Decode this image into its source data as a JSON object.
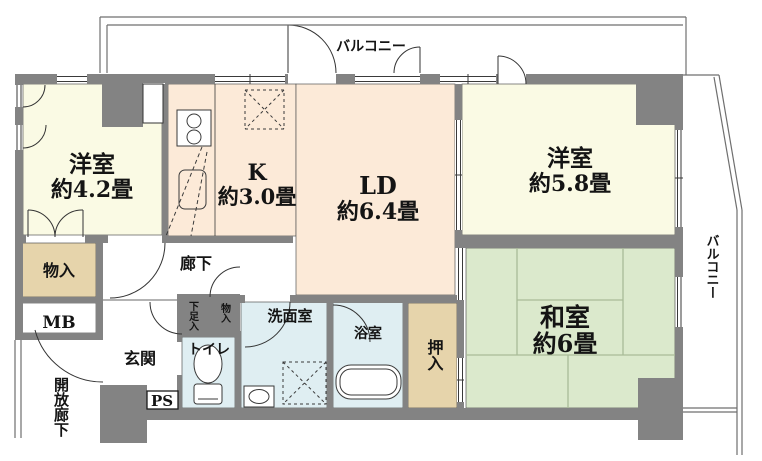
{
  "title": "マンション間取り図",
  "colors": {
    "wall": "#838383",
    "western_room": "#fafae4",
    "kitchen_ld": "#fcead8",
    "tatami": "#dbe9cc",
    "closet": "#e6d4ab",
    "wet_area": "#dfeef2",
    "line": "#3a3a3a"
  },
  "balcony": {
    "top_label": "バルコニー",
    "right_label": "バルコニー"
  },
  "rooms": {
    "western1": {
      "name": "洋室",
      "size": "約4.2畳"
    },
    "kitchen": {
      "name": "K",
      "size": "約3.0畳"
    },
    "living_dining": {
      "name": "LD",
      "size": "約6.4畳"
    },
    "western2": {
      "name": "洋室",
      "size": "約5.8畳"
    },
    "japanese": {
      "name": "和室",
      "size": "約6畳"
    },
    "corridor": {
      "label": "廊下"
    },
    "entrance": {
      "label": "玄関"
    },
    "toilet": {
      "label": "トイレ"
    },
    "washroom": {
      "label": "洗面室"
    },
    "bathroom": {
      "label": "浴室"
    },
    "oshiire": {
      "label": "押入"
    },
    "storage": {
      "label": "物入"
    },
    "storage_small": {
      "label": "物入"
    },
    "shoe_cabinet": {
      "label": "下足入"
    },
    "meter_box": {
      "label": "MB"
    },
    "pipe_space": {
      "label": "PS"
    },
    "open_corridor": {
      "label": "開放廊下"
    }
  }
}
